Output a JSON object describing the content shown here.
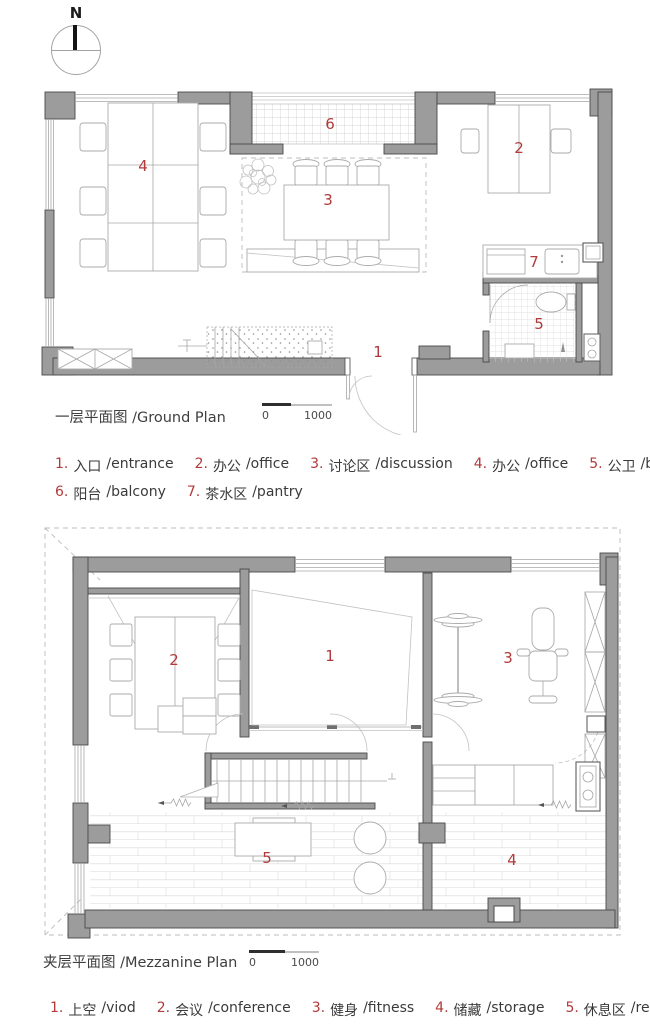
{
  "compass": {
    "label": "N"
  },
  "colors": {
    "accent_red": "#b13a3a",
    "wall_gray": "#9c9c9c",
    "line_gray": "#aaaaaa",
    "text_dark": "#3c3c3c"
  },
  "ground_plan": {
    "title": "一层平面图 /Ground Plan",
    "scale_bar": {
      "start": "0",
      "end": "1000"
    },
    "room_numbers": [
      "1",
      "2",
      "3",
      "4",
      "5",
      "6",
      "7"
    ],
    "legend": [
      {
        "num": "1.",
        "zh": "入口",
        "en": "/entrance"
      },
      {
        "num": "2.",
        "zh": "办公",
        "en": "/office"
      },
      {
        "num": "3.",
        "zh": "讨论区",
        "en": "/discussion"
      },
      {
        "num": "4.",
        "zh": "办公",
        "en": "/office"
      },
      {
        "num": "5.",
        "zh": "公卫",
        "en": "/bath"
      },
      {
        "num": "6.",
        "zh": "阳台",
        "en": "/balcony"
      },
      {
        "num": "7.",
        "zh": "茶水区",
        "en": "/pantry"
      }
    ]
  },
  "mezzanine_plan": {
    "title": "夹层平面图 /Mezzanine Plan",
    "scale_bar": {
      "start": "0",
      "end": "1000"
    },
    "room_numbers": [
      "1",
      "2",
      "3",
      "4",
      "5"
    ],
    "legend": [
      {
        "num": "1.",
        "zh": "上空",
        "en": "/viod"
      },
      {
        "num": "2.",
        "zh": "会议",
        "en": "/conference"
      },
      {
        "num": "3.",
        "zh": "健身",
        "en": "/fitness"
      },
      {
        "num": "4.",
        "zh": "储藏",
        "en": "/storage"
      },
      {
        "num": "5.",
        "zh": "休息区",
        "en": "/rest"
      }
    ]
  }
}
